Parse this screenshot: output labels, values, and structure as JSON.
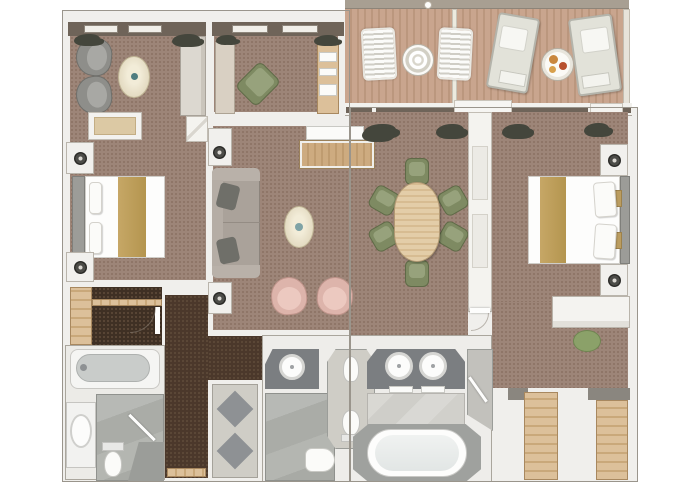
{
  "meta": {
    "title": "Two-bedroom suite floor plan",
    "view": "top-down 3D rendered architectural floor plan",
    "canvas": {
      "width": 680,
      "height": 486
    }
  },
  "colors": {
    "wall": "#f0efec",
    "wall_edge": "#b3ada4",
    "carpet": "#9d8578",
    "carpet_dot": "#8b7263",
    "corridor": "#4b382b",
    "corridor_dot": "#5f4b3a",
    "deck": "#c9a58e",
    "deck_stripe": "#bb977e",
    "window_band": "#6f6459",
    "wood_light": "#dcc09a",
    "headboard": "#9c9c98",
    "bed_runner": "#b4954f",
    "green_chair": "#7e8a62",
    "green_chair_light": "#97a27c",
    "pink_chair": "#ddb4ab",
    "pink_chair_light": "#ecc9c0",
    "gray_chair": "#8e8e8a",
    "sofa": "#aaa29a",
    "sofa_pillow": "#6f6f69",
    "cream_table": "#e9e1ca",
    "counter": "#7b7e81",
    "plant": "#44463c",
    "stone": "#cfcdc6",
    "diamond": "#8e9194",
    "rail": "#a89f92"
  },
  "rooms": [
    {
      "id": "veranda",
      "name": "Veranda deck",
      "floor": "teak planks",
      "furniture": [
        "slatted deck chair x2",
        "ornate round table",
        "chaise lounger x2",
        "round service table with breakfast"
      ]
    },
    {
      "id": "sitting-area",
      "name": "Sitting area",
      "floor": "carpet",
      "furniture": [
        "armchair x2",
        "oval side table",
        "bench",
        "wardrobe"
      ]
    },
    {
      "id": "study",
      "name": "Study / foyer",
      "floor": "carpet",
      "furniture": [
        "cabinet",
        "desk with shelves",
        "swivel chair"
      ]
    },
    {
      "id": "bedroom-left",
      "name": "Guest bedroom",
      "floor": "carpet",
      "furniture": [
        "queen bed",
        "nightstand with lamp x2"
      ]
    },
    {
      "id": "living-room",
      "name": "Living room",
      "floor": "carpet",
      "furniture": [
        "sofa with cushions",
        "pedestal lamp x2",
        "oval coffee table",
        "club chair x2",
        "media sideboard",
        "planter x4"
      ]
    },
    {
      "id": "dining-area",
      "name": "Dining area",
      "floor": "carpet",
      "furniture": [
        "oval dining table",
        "dining chair x6"
      ]
    },
    {
      "id": "bedroom-right",
      "name": "Master bedroom",
      "floor": "carpet",
      "furniture": [
        "king bed with pillows",
        "nightstand with lamp x2"
      ]
    },
    {
      "id": "dressing-area",
      "name": "Dressing area",
      "floor": "carpet",
      "furniture": [
        "vanity desk",
        "round stool",
        "walk-in closet x2"
      ]
    },
    {
      "id": "bathroom-left",
      "name": "Guest bathroom",
      "floor": "stone",
      "furniture": [
        "bathtub",
        "washbasin",
        "toilet",
        "shower"
      ]
    },
    {
      "id": "master-bathroom",
      "name": "Master bathroom",
      "floor": "marble",
      "furniture": [
        "single vanity",
        "double vanity with towels",
        "bidet",
        "toilet x2",
        "large soaking tub",
        "walk-in shower x2"
      ]
    },
    {
      "id": "closet",
      "name": "Wardrobe closet",
      "floor": "wood + dark carpet",
      "furniture": [
        "shelving"
      ]
    },
    {
      "id": "entry",
      "name": "Entry vestibule",
      "floor": "stone with diamond inlay",
      "furniture": [
        "entry door"
      ]
    },
    {
      "id": "corridor",
      "name": "Corridor",
      "floor": "dark patterned carpet",
      "furniture": []
    }
  ]
}
